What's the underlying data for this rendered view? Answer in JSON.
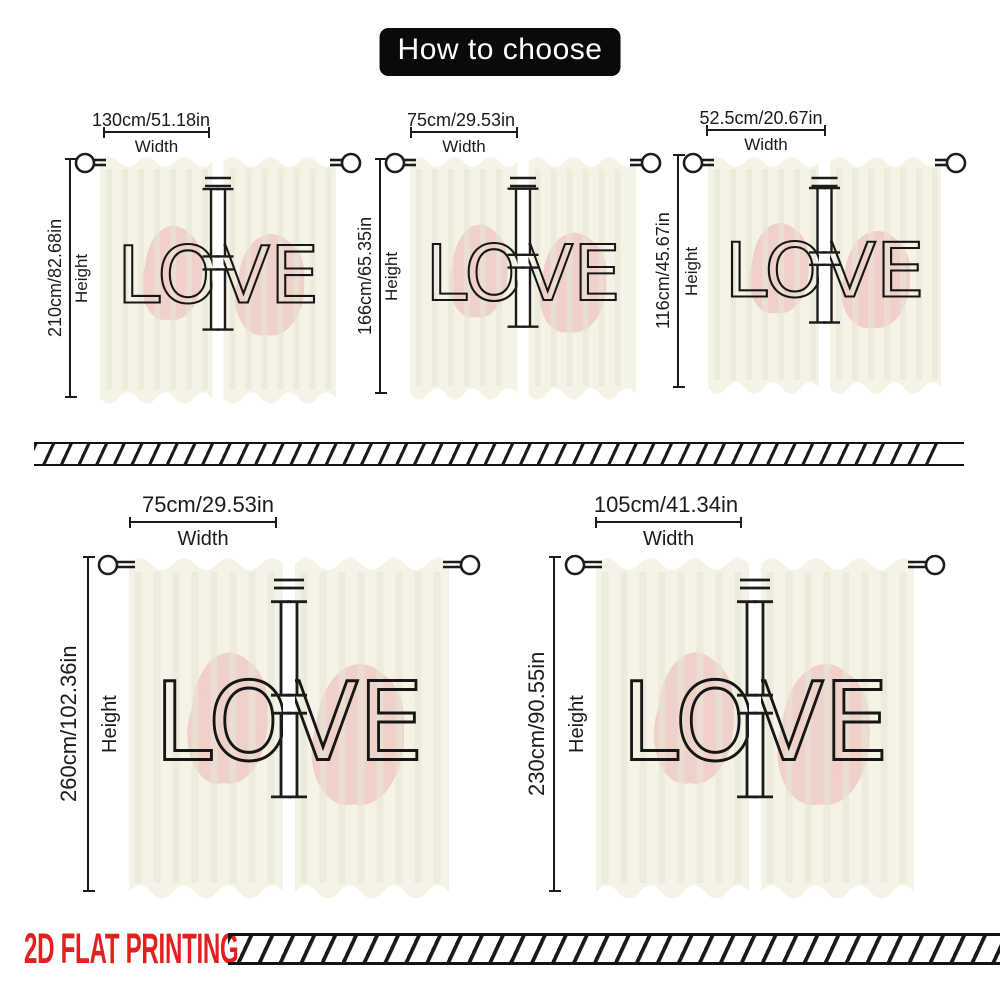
{
  "title": "How to choose",
  "section_labels": {
    "width": "Width",
    "height": "Height"
  },
  "print_text": "LOVE",
  "footer": {
    "label": "2D FLAT PRINTING",
    "color": "#e3201f"
  },
  "colors": {
    "curtain_base": "#f5f3e6",
    "pleat_shade": "#e9e6d5",
    "blob_pink": "#efccc4",
    "outline_black": "#1c1c1c",
    "title_bg": "#0a0a0a",
    "title_text": "#ffffff"
  },
  "curtains": [
    {
      "position": "top-left",
      "width": "130cm/51.18in",
      "height": "210cm/82.68in"
    },
    {
      "position": "top-middle",
      "width": "75cm/29.53in",
      "height": "166cm/65.35in"
    },
    {
      "position": "top-right",
      "width": "52.5cm/20.67in",
      "height": "116cm/45.67in"
    },
    {
      "position": "bottom-left",
      "width": "75cm/29.53in",
      "height": "260cm/102.36in"
    },
    {
      "position": "bottom-right",
      "width": "105cm/41.34in",
      "height": "230cm/90.55in"
    }
  ]
}
